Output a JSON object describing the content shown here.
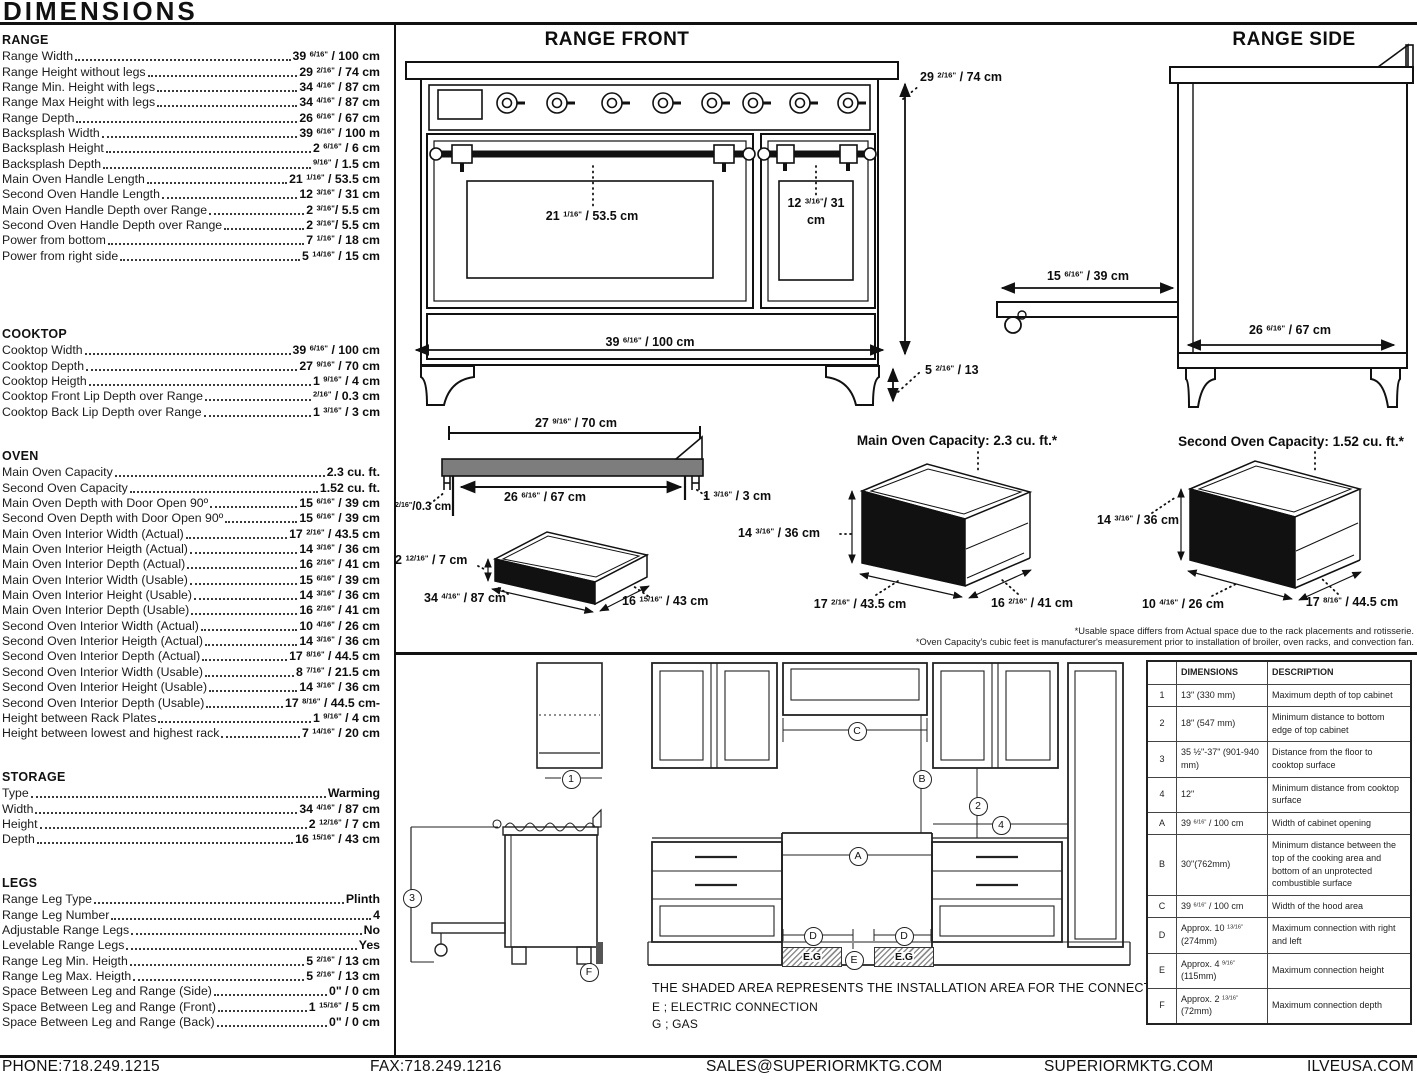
{
  "title": "DIMENSIONS",
  "specs": {
    "range": {
      "heading": "RANGE",
      "rows": [
        {
          "label": "Range Width",
          "value": "39 6/16\" / 100 cm"
        },
        {
          "label": "Range Height without legs",
          "value": "29 2/16\" / 74 cm"
        },
        {
          "label": "Range Min. Height with legs",
          "value": "34 4/16\" / 87 cm"
        },
        {
          "label": "Range Max Height with legs",
          "value": "34 4/16\" / 87 cm"
        },
        {
          "label": "Range Depth",
          "value": "26 6/16\" / 67 cm"
        },
        {
          "label": "Backsplash Width",
          "value": "39 6/16\" / 100 m"
        },
        {
          "label": "Backsplash Height",
          "value": "2 6/16\" / 6 cm"
        },
        {
          "label": "Backsplash Depth",
          "value": "9/16\" / 1.5 cm"
        },
        {
          "label": "Main Oven Handle Length",
          "value": "21 1/16\" / 53.5 cm"
        },
        {
          "label": "Second Oven Handle Length",
          "value": "12 3/16\" / 31 cm"
        },
        {
          "label": "Main Oven Handle Depth over Range",
          "value": "2 3/16\"/ 5.5 cm"
        },
        {
          "label": "Second Oven Handle Depth over Range",
          "value": "2 3/16\"/ 5.5 cm"
        },
        {
          "label": "Power from bottom",
          "value": "7 1/16\" / 18 cm"
        },
        {
          "label": "Power from right side",
          "value": "5 14/16\" / 15 cm"
        }
      ]
    },
    "cooktop": {
      "heading": "COOKTOP",
      "rows": [
        {
          "label": "Cooktop Width",
          "value": "39 6/16\" / 100 cm"
        },
        {
          "label": "Cooktop Depth",
          "value": "27 9/16\" / 70 cm"
        },
        {
          "label": "Cooktop Heigth",
          "value": "1 9/16\" / 4 cm"
        },
        {
          "label": "Cooktop Front Lip Depth over Range",
          "value": "2/16\" / 0.3 cm"
        },
        {
          "label": "Cooktop Back Lip Depth over Range",
          "value": "1 3/16\" / 3 cm"
        }
      ]
    },
    "oven": {
      "heading": "OVEN",
      "rows": [
        {
          "label": "Main Oven Capacity",
          "value": "2.3 cu. ft."
        },
        {
          "label": "Second Oven Capacity",
          "value": "1.52 cu. ft."
        },
        {
          "label": "Main Oven Depth with Door Open 90º",
          "value": "15 6/16\" / 39 cm"
        },
        {
          "label": "Second Oven Depth with Door Open 90º",
          "value": "15 6/16\" / 39 cm"
        },
        {
          "label": "Main Oven Interior Width (Actual)",
          "value": "17 2/16\" / 43.5 cm"
        },
        {
          "label": "Main Oven Interior Heigth (Actual)",
          "value": "14 3/16\" / 36 cm"
        },
        {
          "label": "Main Oven Interior Depth (Actual)",
          "value": "16 2/16\" / 41 cm"
        },
        {
          "label": "Main Oven Interior Width (Usable)",
          "value": "15 6/16\" / 39 cm"
        },
        {
          "label": "Main Oven Interior Height (Usable)",
          "value": "14 3/16\" / 36 cm"
        },
        {
          "label": "Main Oven Interior Depth (Usable)",
          "value": "16 2/16\" / 41 cm"
        },
        {
          "label": "Second Oven Interior Width (Actual)",
          "value": "10 4/16\" / 26 cm"
        },
        {
          "label": "Second Oven Interior Heigth (Actual)",
          "value": "14 3/16\" / 36 cm"
        },
        {
          "label": "Second Oven Interior Depth (Actual)",
          "value": "17 8/16\" / 44.5 cm"
        },
        {
          "label": "Second Oven Interior Width (Usable)",
          "value": "8 7/16\" / 21.5 cm"
        },
        {
          "label": "Second Oven Interior Height (Usable)",
          "value": "14 3/16\" / 36 cm"
        },
        {
          "label": "Second Oven Interior Depth (Usable)",
          "value": "17 8/16\" / 44.5 cm-"
        },
        {
          "label": "Height between Rack Plates",
          "value": "1 9/16\" / 4 cm"
        },
        {
          "label": "Height between lowest and highest rack",
          "value": "7 14/16\" / 20 cm"
        }
      ]
    },
    "storage": {
      "heading": "STORAGE",
      "rows": [
        {
          "label": "Type",
          "value": "Warming"
        },
        {
          "label": "Width",
          "value": "34 4/16\" / 87 cm"
        },
        {
          "label": "Height",
          "value": "2 12/16\" / 7 cm"
        },
        {
          "label": "Depth",
          "value": "16 15/16\" / 43 cm"
        }
      ]
    },
    "legs": {
      "heading": "LEGS",
      "rows": [
        {
          "label": "Range Leg Type",
          "value": "Plinth"
        },
        {
          "label": "Range Leg Number",
          "value": "4"
        },
        {
          "label": "Adjustable Range Legs",
          "value": "No"
        },
        {
          "label": "Levelable Range Legs",
          "value": "Yes"
        },
        {
          "label": "Range Leg Min. Heigth",
          "value": "5 2/16\" / 13 cm"
        },
        {
          "label": "Range Leg Max. Heigth",
          "value": "5 2/16\" / 13 cm"
        },
        {
          "label": "Space Between Leg and Range (Side)",
          "value": "0\" / 0 cm"
        },
        {
          "label": "Space Between Leg and Range (Front)",
          "value": "1 15/16\" / 5 cm"
        },
        {
          "label": "Space Between Leg and Range (Back)",
          "value": "0\" / 0 cm"
        }
      ]
    }
  },
  "range_front": {
    "title": "RANGE FRONT",
    "main_handle": "21 1/16\" / 53.5 cm",
    "second_handle": "12 3/16\"/ 31 cm",
    "width": "39 6/16\" / 100 cm",
    "height": "29 2/16\" / 74 cm",
    "leg_height": "5 2/16\" / 13"
  },
  "range_side": {
    "title": "RANGE SIDE",
    "door_depth": "15 6/16\" / 39 cm",
    "depth": "26 6/16\" / 67 cm"
  },
  "cooktop_diagram": {
    "top_width": "27 9/16\" / 70 cm",
    "inner_width": "26 6/16\" / 67 cm",
    "front_lip": "2/16\"/0.3 cm",
    "back_lip": "1 3/16\" / 3 cm"
  },
  "storage_diagram": {
    "height": "2 12/16\" / 7 cm",
    "width": "34 4/16\" / 87 cm",
    "depth": "16 15/16\" / 43 cm"
  },
  "main_oven_diagram": {
    "title": "Main Oven Capacity: 2.3 cu. ft.*",
    "height": "14 3/16\" / 36 cm",
    "width": "17 2/16\" / 43.5 cm",
    "depth": "16 2/16\" / 41 cm"
  },
  "second_oven_diagram": {
    "title": "Second Oven Capacity: 1.52 cu. ft.*",
    "height": "14 3/16\" / 36 cm",
    "width": "10 4/16\" / 26 cm",
    "depth": "17 8/16\" / 44.5 cm"
  },
  "footnotes": [
    "*Usable space differs from Actual space due to the rack placements and rotisserie.",
    "*Oven Capacity's cubic feet is manufacturer's measurement prior to installation of broiler, oven racks, and convection fan."
  ],
  "installation": {
    "callouts": {
      "one": "1",
      "two": "2",
      "three": "3",
      "four": "4",
      "A": "A",
      "B": "B",
      "C": "C",
      "D": "D",
      "E": "E",
      "F": "F"
    },
    "shaded": "E.G",
    "note": "THE SHADED AREA REPRESENTS THE INSTALLATION AREA FOR THE CONNECTIONS;",
    "legend_e": "E ; ELECTRIC CONNECTION",
    "legend_g": "G ; GAS"
  },
  "table": {
    "corner": "",
    "headers": [
      "DIMENSIONS",
      "DESCRIPTION"
    ],
    "rows": [
      {
        "id": "1",
        "dim": "13\" (330 mm)",
        "desc": "Maximum depth of top cabinet"
      },
      {
        "id": "2",
        "dim": "18\" (547 mm)",
        "desc": "Minimum distance to bottom edge of top cabinet"
      },
      {
        "id": "3",
        "dim": "35 ½\"-37\" (901-940 mm)",
        "desc": "Distance from the floor to cooktop surface"
      },
      {
        "id": "4",
        "dim": "12\"",
        "desc": "Minimum distance from cooktop surface"
      },
      {
        "id": "A",
        "dim": "39 6/16\" / 100 cm",
        "desc": "Width of cabinet opening"
      },
      {
        "id": "B",
        "dim": "30\"(762mm)",
        "desc": "Minimum distance between the top of the cooking area and bottom of an unprotected combustible surface"
      },
      {
        "id": "C",
        "dim": "39 6/16\" / 100 cm",
        "desc": "Width of the hood area"
      },
      {
        "id": "D",
        "dim": "Approx. 10 13/16\" (274mm)",
        "desc": "Maximum connection with right and left"
      },
      {
        "id": "E",
        "dim": "Approx. 4 9/16\" (115mm)",
        "desc": "Maximum connection height"
      },
      {
        "id": "F",
        "dim": "Approx. 2 13/16\" (72mm)",
        "desc": "Maximum connection depth"
      }
    ]
  },
  "footer": {
    "phone": "PHONE:718.249.1215",
    "fax": "FAX:718.249.1216",
    "email": "SALES@SUPERIORMKTG.COM",
    "site": "SUPERIORMKTG.COM",
    "site2": "ILVEUSA.COM"
  },
  "colors": {
    "ink": "#111111",
    "slab_gray": "#7d7d7d",
    "connection_gray": "#555555"
  }
}
